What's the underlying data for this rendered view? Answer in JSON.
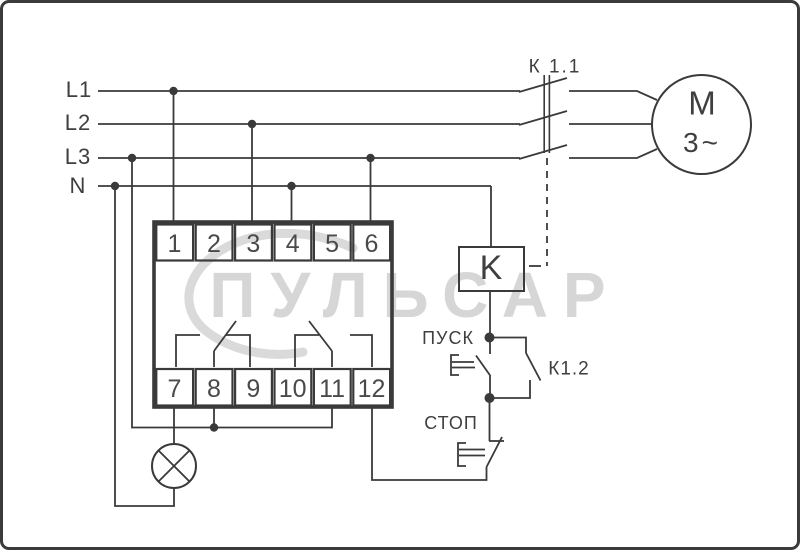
{
  "watermark": {
    "text": "ПУЛЬСАР"
  },
  "power_lines": {
    "l1": "L1",
    "l2": "L2",
    "l3": "L3",
    "n": "N"
  },
  "device": {
    "top_terminals": [
      "1",
      "2",
      "3",
      "4",
      "5",
      "6"
    ],
    "bottom_terminals": [
      "7",
      "8",
      "9",
      "10",
      "11",
      "12"
    ]
  },
  "contactor": {
    "main_contacts_label": "К 1.1",
    "coil_label": "K",
    "aux_contact_label": "К1.2"
  },
  "motor": {
    "letter": "M",
    "phases": "3~"
  },
  "controls": {
    "start_label": "ПУСК",
    "stop_label": "СТОП"
  },
  "colors": {
    "line": "#3a3a3a",
    "watermark": "#d6d6d6"
  }
}
